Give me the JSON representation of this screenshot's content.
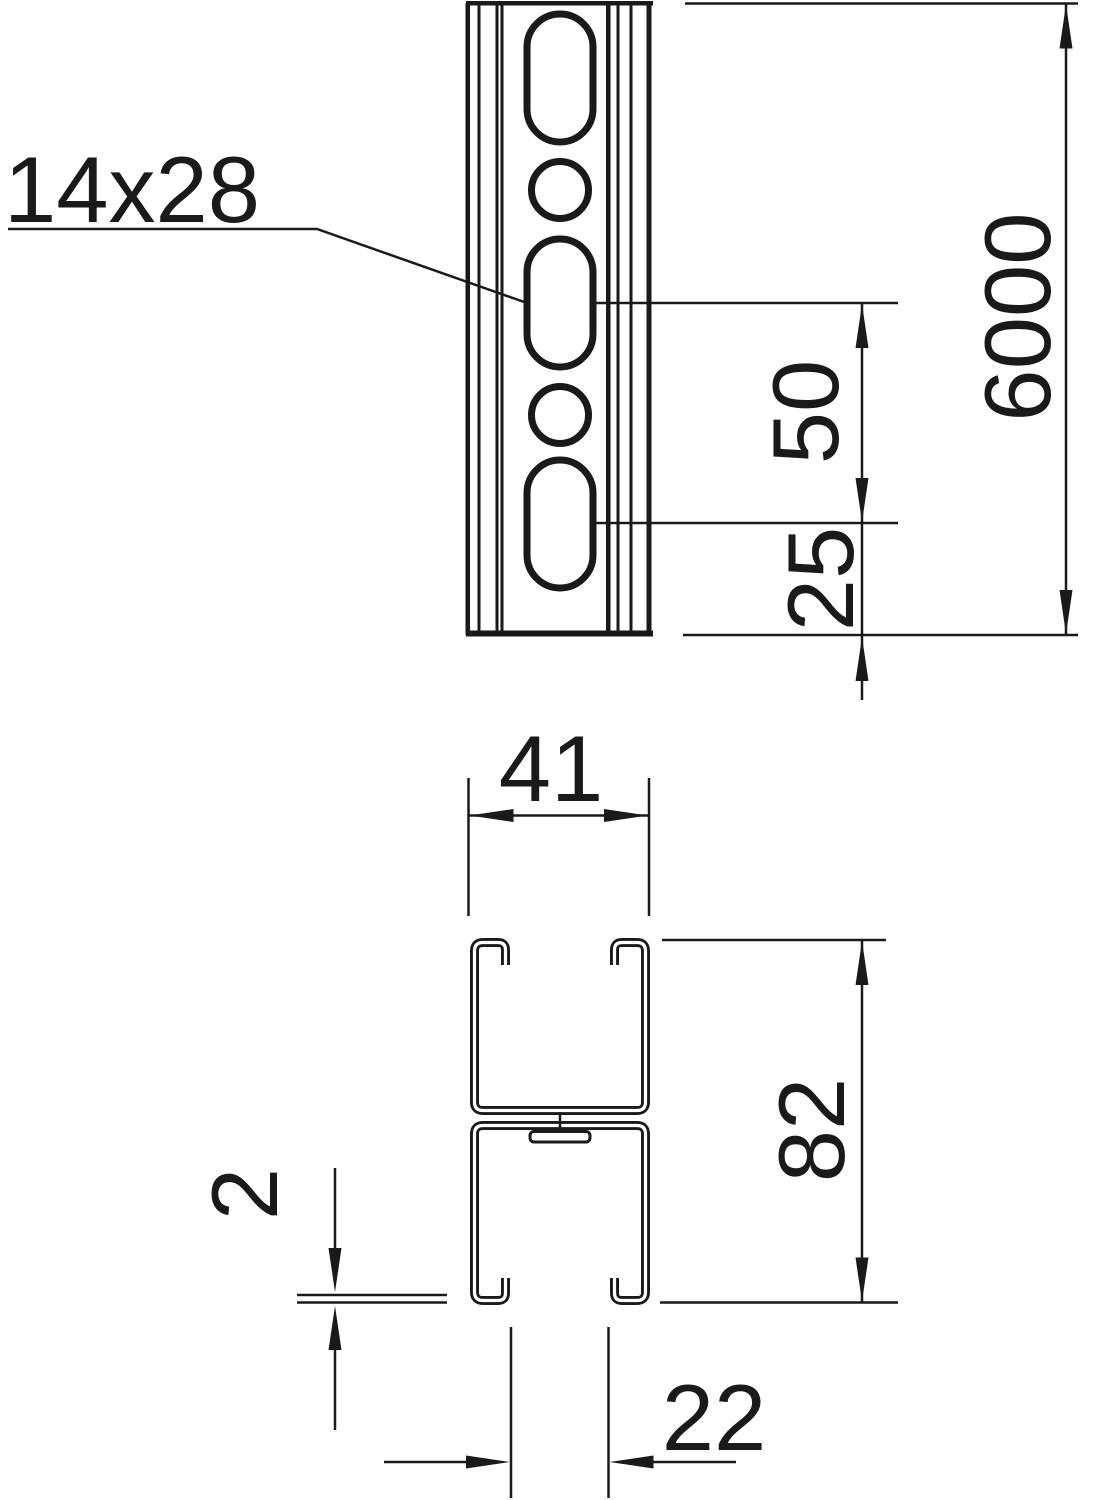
{
  "drawing": {
    "type": "technical-dimension-drawing",
    "views": {
      "front_view": "perforated profile rail, front elevation with slotted holes",
      "section_view": "double C-profile cross-section"
    },
    "labels": {
      "slot_size": "14x28",
      "total_length": "6000",
      "hole_pitch": "50",
      "end_offset": "25",
      "profile_width": "41",
      "profile_height": "82",
      "material_thickness": "2",
      "slot_opening": "22"
    },
    "colors": {
      "line": "#1a1a1a",
      "background": "#ffffff"
    }
  }
}
